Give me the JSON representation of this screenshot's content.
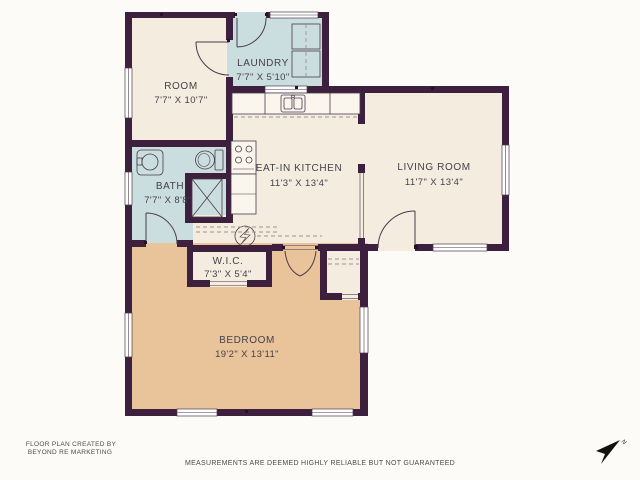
{
  "floor_plan": {
    "rooms": [
      {
        "name": "ROOM",
        "dimensions": "7'7\" X 10'7\""
      },
      {
        "name": "LAUNDRY",
        "dimensions": "7'7\" X 5'10\""
      },
      {
        "name": "EAT-IN KITCHEN",
        "dimensions": "11'3\" X 13'4\""
      },
      {
        "name": "LIVING ROOM",
        "dimensions": "11'7\" X 13'4\""
      },
      {
        "name": "BATH",
        "dimensions": "7'7\" X 8'8\""
      },
      {
        "name": "W.I.C.",
        "dimensions": "7'3\" X 5'4\""
      },
      {
        "name": "BEDROOM",
        "dimensions": "19'2\" X 13'11\""
      }
    ],
    "compass_label": "N",
    "colors": {
      "wall": "#3d1f3e",
      "dry_room_cream": "#f3ecdf",
      "wet_room_blue": "#cbdedf",
      "bedroom_tan": "#e9c39a",
      "background": "#fcfbf7"
    }
  },
  "footer": {
    "credit_line1": "FLOOR PLAN CREATED BY",
    "credit_line2": "BEYOND RE MARKETING",
    "disclaimer": "MEASUREMENTS ARE DEEMED HIGHLY RELIABLE BUT NOT GUARANTEED"
  }
}
